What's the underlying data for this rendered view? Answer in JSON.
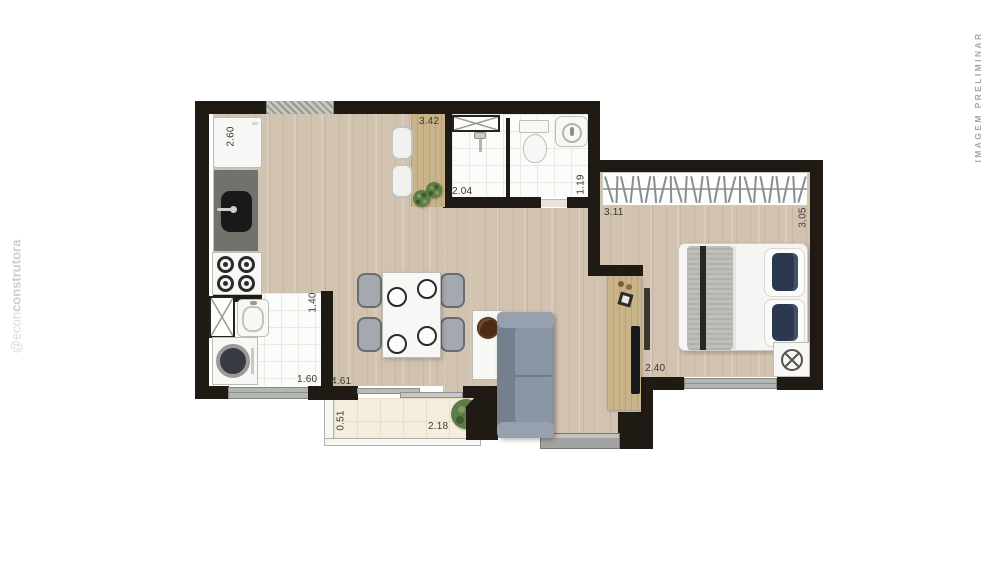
{
  "watermarks": {
    "left_prefix": "@econ",
    "left_suffix": "construtora",
    "right": "IMAGEM PRELIMINAR"
  },
  "dimensions": {
    "fridge_wall": "2.60",
    "desk_wall": "3.42",
    "shower_width": "2.04",
    "lavatory_width": "1.19",
    "closet_wall": "3.11",
    "bedroom_depth": "3.05",
    "service_width": "1.40",
    "service_length": "1.60",
    "living_width": "4.61",
    "balcony_depth": "0.51",
    "balcony_width": "2.18",
    "bedroom_width": "2.40"
  },
  "closet": {
    "hanger_count": 26
  },
  "palette": {
    "wall": "#201a15",
    "wood_floor": "#d2c3b1",
    "wood_furniture": "#c9b389",
    "tile": "#fbfbfa",
    "balcony_tile": "#f5eedd",
    "sofa": "#8591a2",
    "pillow_navy": "#2b3850",
    "plant_green": "#5d7c46",
    "label_text": "#3a3833",
    "watermark_left": "#d6d6d6",
    "watermark_right": "#a6a6a6"
  }
}
